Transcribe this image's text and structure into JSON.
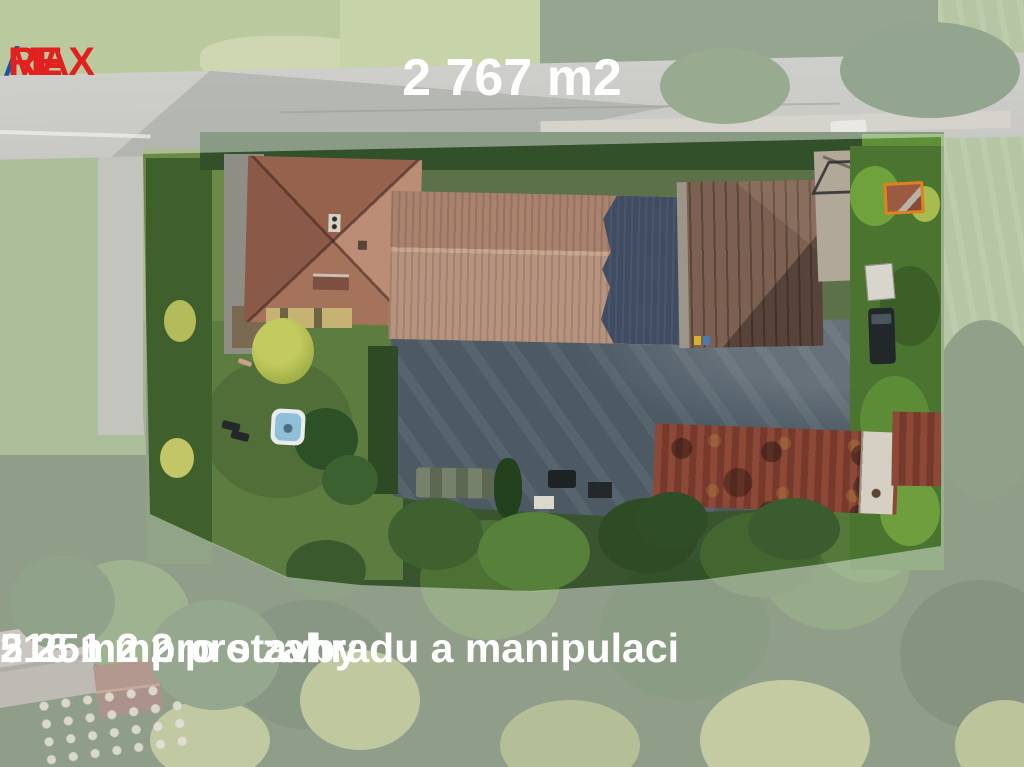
{
  "overlay": {
    "logo": {
      "re": "RE",
      "slash": "/",
      "max": "MAX"
    },
    "title": "2 767 m2",
    "caption_line1": "516 m2 pro stavby",
    "caption_line2": "2 251 m2 pro zahradu a manipulaci"
  },
  "property": {
    "total_area": "2 767 m2",
    "buildings_area": "516 m2",
    "garden_and_handling_area": "2 251 m2"
  },
  "palette": {
    "remax_red": "#e2201f",
    "remax_blue": "#1358a5",
    "text_white": "#ffffff",
    "boundary_mask": "rgba(255,255,255,0.43)",
    "asphalt_yard": "#4d5a64",
    "lawn_green": "#5d7c3f",
    "house_roof": "#a5725c",
    "warehouse_roof": "#b6937e",
    "metal_roof": "#7c6052",
    "barn_roof": "#82412f",
    "marker_orange": "#e0801f"
  }
}
